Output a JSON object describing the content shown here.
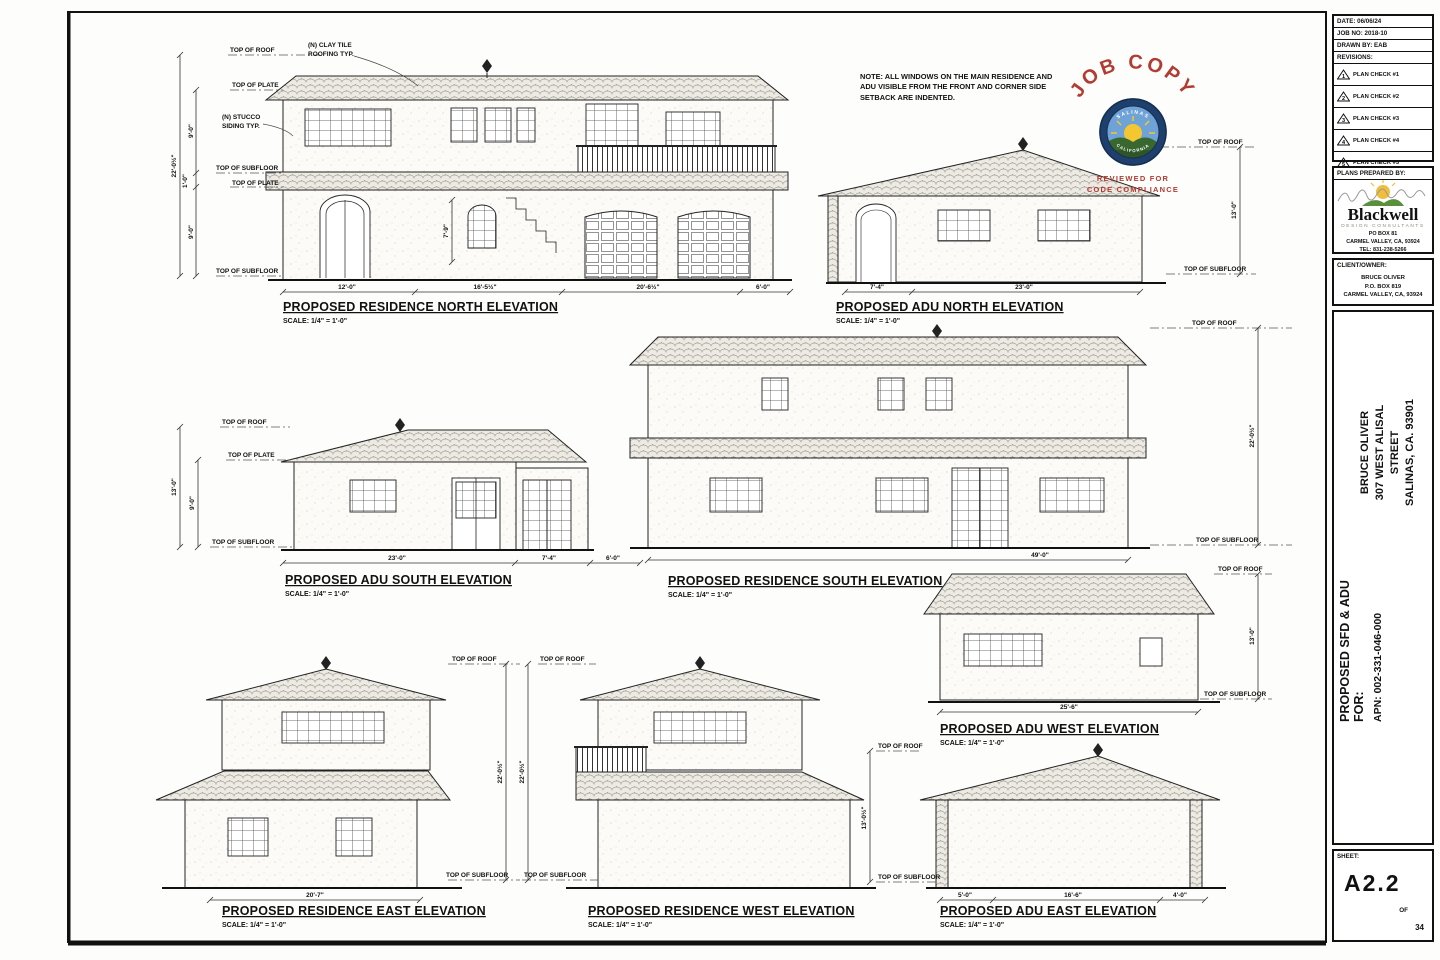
{
  "page": {
    "bg": "#fdfdfb",
    "line_color": "#1f1f1f",
    "accent_red": "#b23b32"
  },
  "note": {
    "text": "NOTE: ALL WINDOWS ON THE MAIN RESIDENCE AND ADU VISIBLE FROM THE FRONT AND CORNER SIDE SETBACK ARE INDENTED."
  },
  "stamp": {
    "title": "JOB COPY",
    "seal_top": "SALINAS",
    "seal_bottom": "CALIFORNIA",
    "reviewed_line1": "REVIEWED FOR",
    "reviewed_line2": "CODE COMPLIANCE",
    "color": "#b23b32"
  },
  "labels": {
    "top_of_roof": "TOP OF ROOF",
    "top_of_plate": "TOP OF PLATE",
    "top_of_subfloor": "TOP OF SUBFLOOR",
    "clay_tile_1": "(N) CLAY TILE",
    "clay_tile_2": "ROOFING TYP.",
    "stucco_1": "(N) STUCCO",
    "stucco_2": "SIDING TYP."
  },
  "elevations": {
    "res_north": {
      "title": "PROPOSED RESIDENCE NORTH ELEVATION",
      "scale": "SCALE: 1/4\" = 1'-0\"",
      "dims": {
        "w1": "12'-0\"",
        "w2": "16'-5½\"",
        "w3": "20'-6½\"",
        "w4": "6'-0\"",
        "overall_h": "22'-0½\"",
        "upper_h": "9'-0\"",
        "band_h": "1'-0\"",
        "lower_h": "9'-0\"",
        "stair_h": "7'-9\""
      }
    },
    "adu_north": {
      "title": "PROPOSED ADU NORTH ELEVATION",
      "scale": "SCALE: 1/4\" = 1'-0\"",
      "dims": {
        "w1": "7'-4\"",
        "w2": "23'-0\"",
        "h1": "13'-0\""
      }
    },
    "adu_south": {
      "title": "PROPOSED ADU SOUTH ELEVATION",
      "scale": "SCALE: 1/4\" = 1'-0\"",
      "dims": {
        "w1": "23'-0\"",
        "w2": "7'-4\"",
        "w3": "6'-0\"",
        "h1": "13'-0\"",
        "h2": "9'-0\""
      }
    },
    "res_south": {
      "title": "PROPOSED RESIDENCE SOUTH ELEVATION",
      "scale": "SCALE: 1/4\" = 1'-0\"",
      "dims": {
        "w1": "49'-0\"",
        "h1": "22'-0½\""
      }
    },
    "res_east": {
      "title": "PROPOSED RESIDENCE EAST ELEVATION",
      "scale": "SCALE: 1/4\" = 1'-0\"",
      "dims": {
        "w1": "20'-7\"",
        "h1": "22'-0½\""
      }
    },
    "res_west": {
      "title": "PROPOSED RESIDENCE WEST ELEVATION",
      "scale": "SCALE: 1/4\" = 1'-0\"",
      "dims": {
        "h1": "22'-0½\""
      }
    },
    "adu_west": {
      "title": "PROPOSED ADU WEST ELEVATION",
      "scale": "SCALE: 1/4\" = 1'-0\"",
      "dims": {
        "w1": "25'-6\"",
        "h1": "13'-0\""
      }
    },
    "adu_east": {
      "title": "PROPOSED ADU EAST ELEVATION",
      "scale": "SCALE: 1/4\" = 1'-0\"",
      "dims": {
        "w1": "5'-0\"",
        "w2": "16'-6\"",
        "w3": "4'-0\"",
        "h1": "13'-0½\""
      }
    }
  },
  "titleblock": {
    "date": "DATE: 06/06/24",
    "job_no": "JOB NO: 2018-10",
    "drawn_by": "DRAWN BY: EAB",
    "revisions_label": "REVISIONS:",
    "revisions": [
      {
        "marker": "1",
        "label": "PLAN CHECK #1"
      },
      {
        "marker": "2",
        "label": "PLAN CHECK #2"
      },
      {
        "marker": "3",
        "label": "PLAN CHECK #3"
      },
      {
        "marker": "4",
        "label": "PLAN CHECK #4"
      },
      {
        "marker": "5",
        "label": "PLAN CHECK #5"
      }
    ],
    "prepared_by_label": "PLANS PREPARED BY:",
    "firm": {
      "name": "Blackwell",
      "tagline": "DESIGN CONSULTANTS",
      "addr1": "PO BOX 81",
      "addr2": "CARMEL VALLEY, CA, 93924",
      "tel": "TEL: 831-238-5266"
    },
    "client_label": "CLIENT/OWNER:",
    "client": {
      "name": "BRUCE OLIVER",
      "addr1": "P.O. BOX 819",
      "addr2": "CARMEL VALLEY, CA, 93924"
    },
    "project": {
      "owner": "BRUCE OLIVER",
      "addr1": "307 WEST ALISAL STREET",
      "addr2": "SALINAS, CA. 93901",
      "for_label": "PROPOSED SFD & ADU FOR:",
      "apn": "APN: 002-331-046-000"
    },
    "sheet_label": "SHEET:",
    "sheet_number": "A2.2",
    "of_label": "OF",
    "sheet_total": "34"
  }
}
